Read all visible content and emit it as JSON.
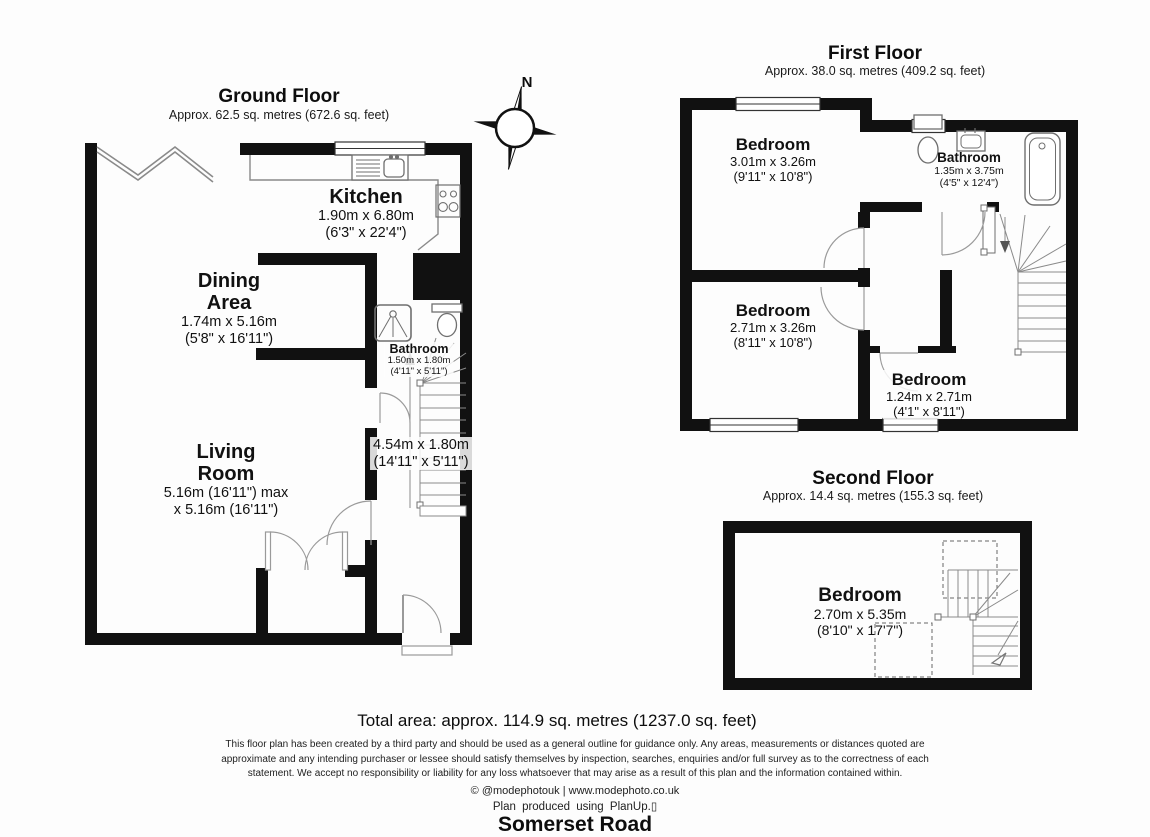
{
  "meta": {
    "compass_label": "N",
    "wall_color": "#111111",
    "line_color": "#7d7d7d",
    "background": "#fdfdfd"
  },
  "floors": {
    "ground": {
      "title": "Ground Floor",
      "area": "Approx. 62.5 sq. metres (672.6 sq. feet)",
      "rooms": {
        "kitchen": {
          "name": "Kitchen",
          "m": "1.90m x 6.80m",
          "ft": "(6'3\" x 22'4\")"
        },
        "dining": {
          "name1": "Dining",
          "name2": "Area",
          "m": "1.74m x 5.16m",
          "ft": "(5'8\" x 16'11\")"
        },
        "bathroom": {
          "name": "Bathroom",
          "m": "1.50m x 1.80m",
          "ft": "(4'11\" x 5'11\")"
        },
        "living": {
          "name1": "Living",
          "name2": "Room",
          "m": "5.16m (16'11\") max",
          "ft": "x 5.16m (16'11\")"
        },
        "hall": {
          "m": "4.54m x 1.80m",
          "ft": "(14'11\" x 5'11\")"
        }
      }
    },
    "first": {
      "title": "First Floor",
      "area": "Approx. 38.0 sq. metres (409.2 sq. feet)",
      "rooms": {
        "bedroom1": {
          "name": "Bedroom",
          "m": "3.01m x 3.26m",
          "ft": "(9'11\" x 10'8\")"
        },
        "bathroom": {
          "name": "Bathroom",
          "m": "1.35m x 3.75m",
          "ft": "(4'5\" x 12'4\")"
        },
        "bedroom2": {
          "name": "Bedroom",
          "m": "2.71m x 3.26m",
          "ft": "(8'11\" x 10'8\")"
        },
        "bedroom3": {
          "name": "Bedroom",
          "m": "1.24m x 2.71m",
          "ft": "(4'1\" x 8'11\")"
        }
      }
    },
    "second": {
      "title": "Second Floor",
      "area": "Approx. 14.4 sq. metres (155.3 sq. feet)",
      "rooms": {
        "bedroom": {
          "name": "Bedroom",
          "m": "2.70m x 5.35m",
          "ft": "(8'10\" x 17'7\")"
        }
      }
    }
  },
  "footer": {
    "total_area": "Total area: approx. 114.9 sq. metres (1237.0 sq. feet)",
    "disclaimer": "This floor plan has been created by a third party and should be used as a general outline for guidance only. Any areas, measurements or distances quoted are approximate and any intending purchaser or lessee should satisfy themselves by inspection, searches, enquiries and/or full survey as to the correctness of each statement. We accept no responsibility or liability for any loss whatsoever that may arise as a result of this plan and the information contained within.",
    "credit_line1": "© @modephotouk | www.modephoto.co.uk",
    "credit_line2": "Plan produced using PlanUp.▯",
    "address": "Somerset Road"
  }
}
